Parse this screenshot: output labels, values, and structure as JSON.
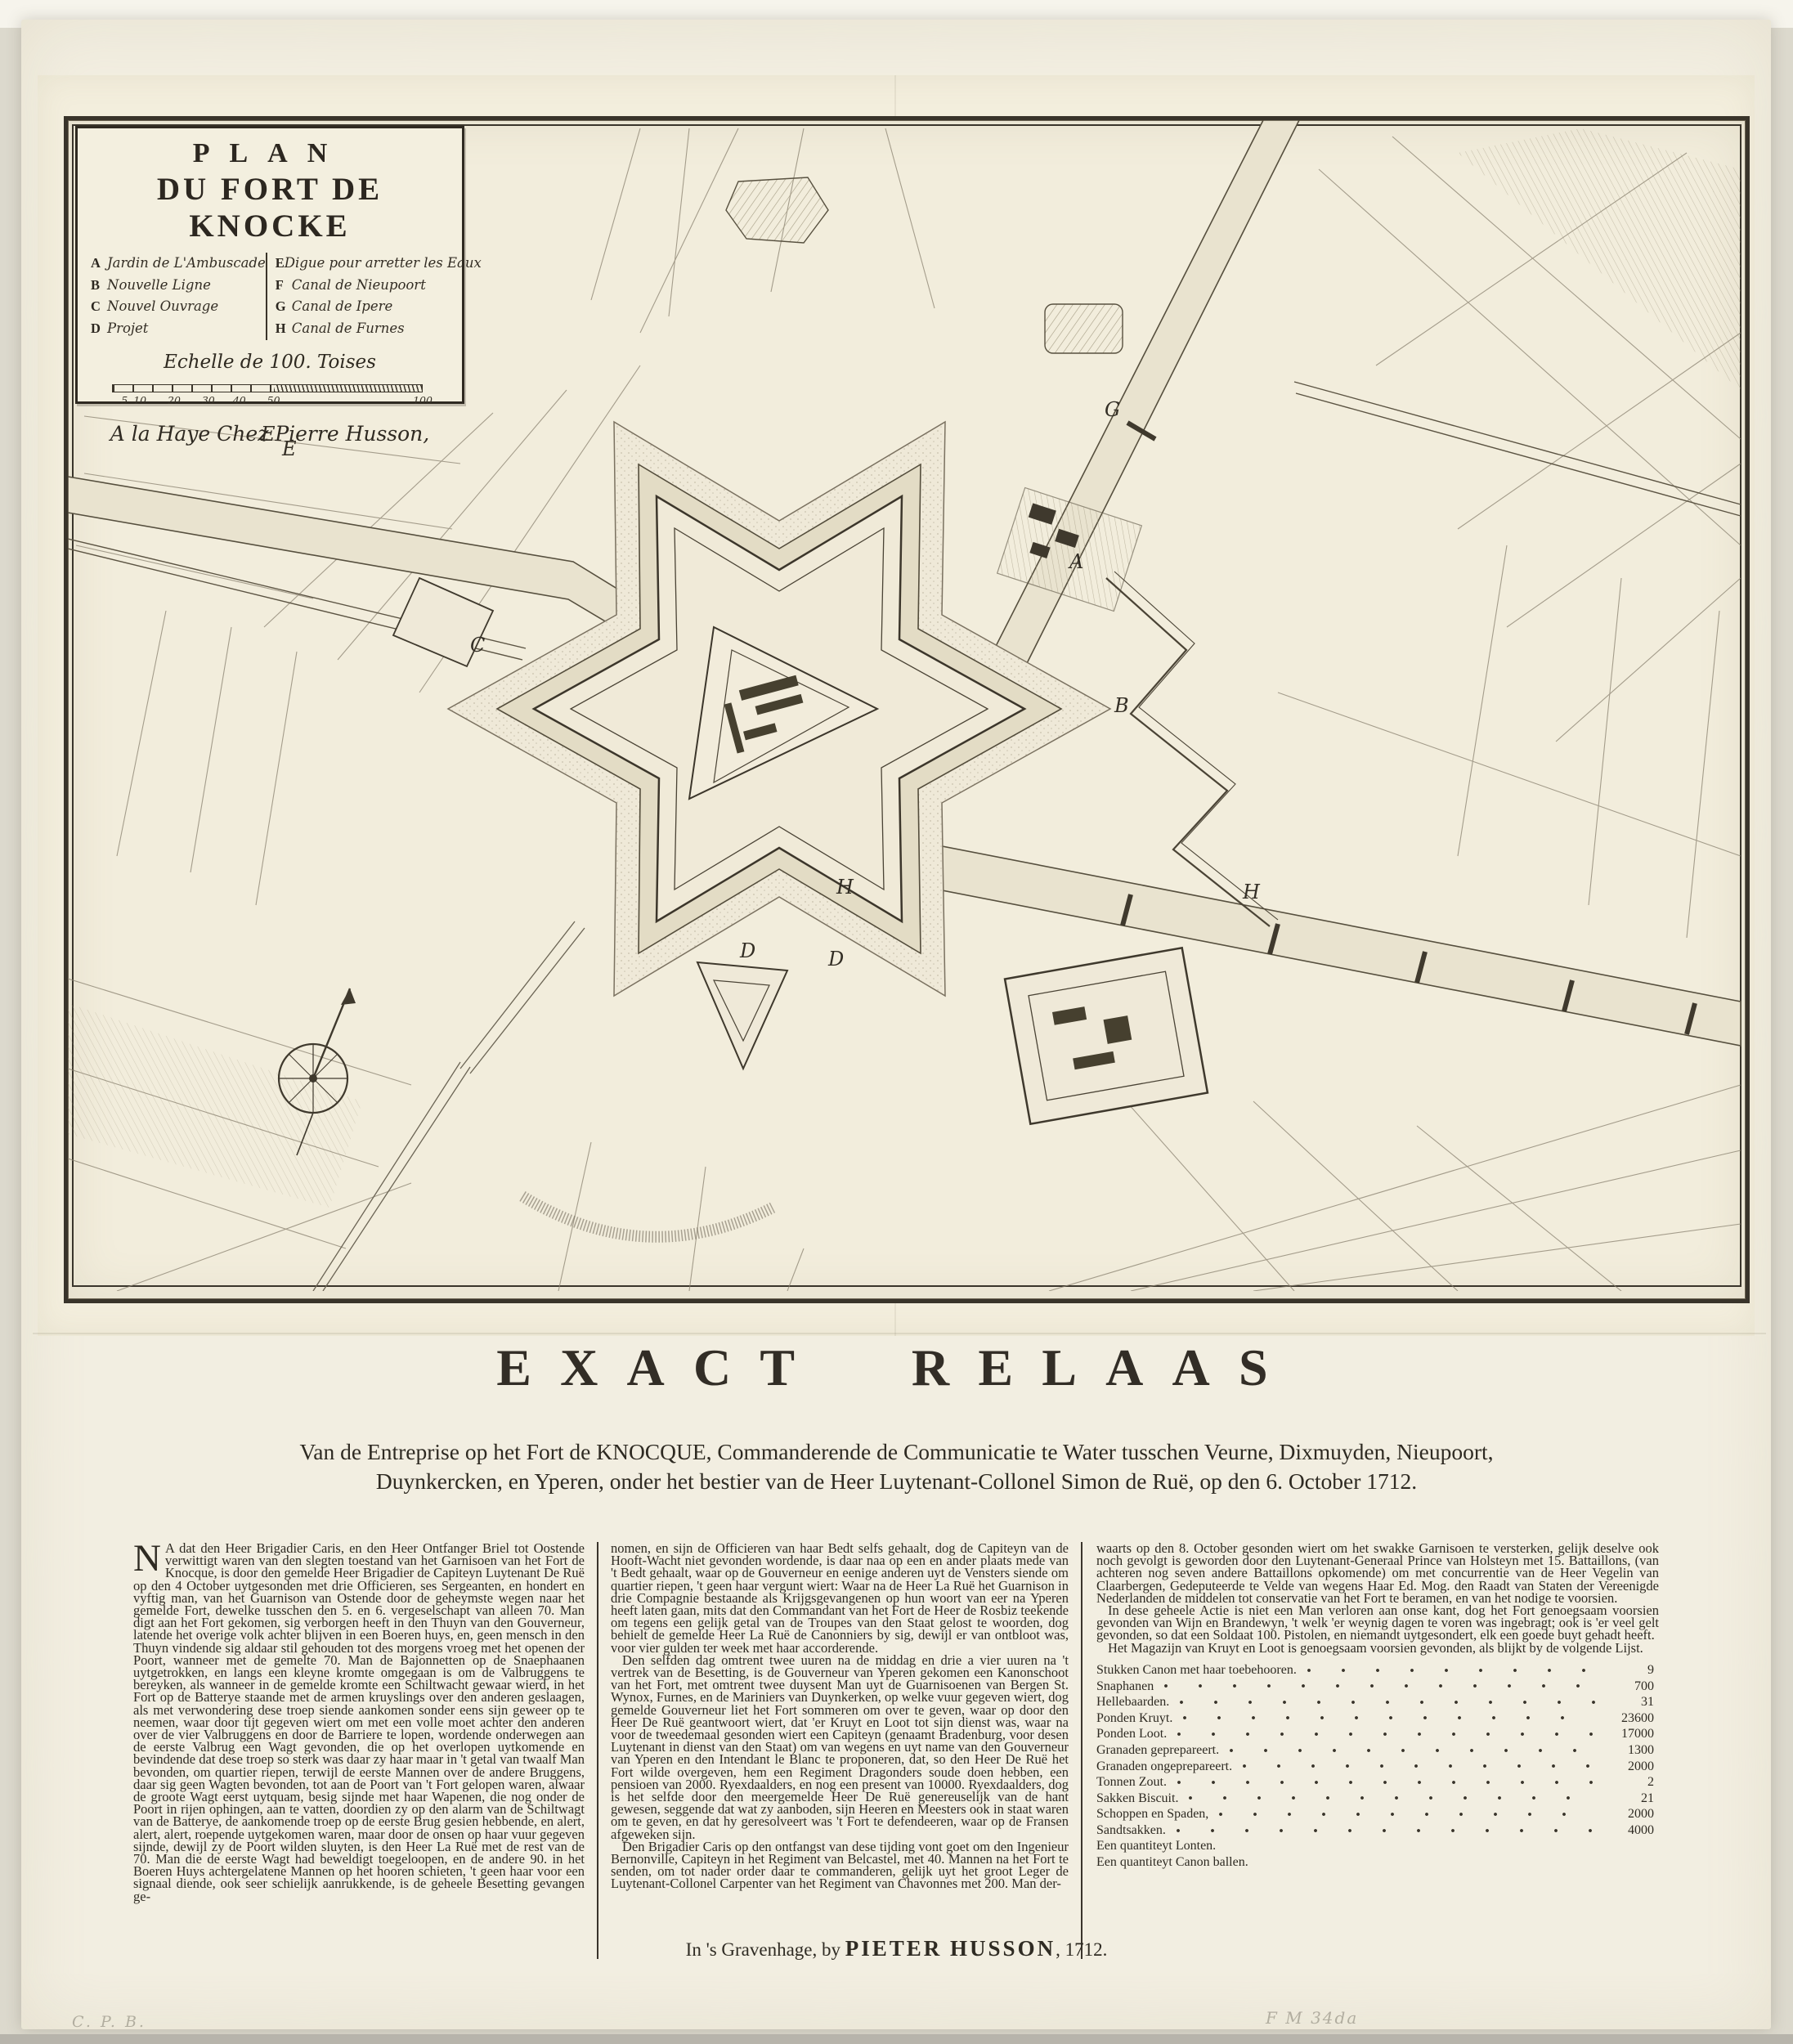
{
  "map": {
    "cartouche": {
      "title_line1": "PLAN",
      "title_line2": "DU FORT DE KNOCKE",
      "legend_left": [
        {
          "key": "A",
          "label": "Jardin de L'Ambuscade"
        },
        {
          "key": "B",
          "label": "Nouvelle Ligne"
        },
        {
          "key": "C",
          "label": "Nouvel Ouvrage"
        },
        {
          "key": "D",
          "label": "Projet"
        }
      ],
      "legend_right": [
        {
          "key": "E",
          "label": "Digue pour arretter les Eaux"
        },
        {
          "key": "F",
          "label": "Canal de Nieupoort"
        },
        {
          "key": "G",
          "label": "Canal de Ipere"
        },
        {
          "key": "H",
          "label": "Canal de Furnes"
        }
      ],
      "scale_label": "Echelle de 100. Toises",
      "scale_ticks": [
        "5",
        "10",
        "20",
        "30",
        "40",
        "50",
        "100"
      ],
      "imprint": "A la Haye Chez Pierre Husson,"
    },
    "letters": [
      "F",
      "E",
      "E",
      "G",
      "A",
      "B",
      "C",
      "D",
      "H",
      "D",
      "H"
    ]
  },
  "relaas": {
    "heading": "EXACT RELAAS",
    "subtitle_line1": "Van de Entreprise op het Fort de KNOCQUE, Commanderende de Communicatie te Water tusschen Veurne, Dixmuyden, Nieupoort,",
    "subtitle_line2": "Duynkercken, en Yperen, onder het bestier van de Heer Luytenant-Collonel Simon de Ruë, op den 6. October 1712.",
    "dropcap": "N",
    "col1_first": "A dat den Heer Brigadier Caris, en den Heer Ontfanger Briel tot Oostende verwittigt waren van den slegten toestand van het Garnisoen van het Fort de Knocque, is door den gemelde Heer Brigadier de Capiteyn Luytenant De Ruë op den 4 October uytgesonden met drie Officieren, ses Sergeanten, en hondert en vyftig man, van het Guarnison van Ostende door de geheymste wegen naar het gemelde Fort, dewelke tusschen den 5. en 6. vergeselschapt van alleen 70. Man digt aan het Fort gekomen, sig verborgen heeft in den Thuyn van den Gouverneur, latende het overige volk achter blijven in een Boeren huys, en, geen mensch in den Thuyn vindende sig aldaar stil gehouden tot des morgens vroeg met het openen der Poort, wanneer met de gemelte 70. Man de Bajonnetten op de Snaephaanen uytgetrokken, en langs een kleyne kromte omgegaan is om de Valbruggens te bereyken, als wanneer in de gemelde kromte een Schiltwacht gewaar wierd, in het Fort op de Batterye staande met de armen kruyslings over den anderen geslaagen, als met verwondering dese troep siende aankomen sonder eens sijn geweer op te neemen, waar door tijt gegeven wiert om met een volle moet achter den anderen over de vier Valbruggens en door de Barriere te lopen, wordende onderwegen aan de eerste Valbrug een Wagt gevonden, die op het overlopen uytkomende en bevindende dat dese troep so sterk was daar zy haar maar in 't getal van twaalf Man bevonden, om quartier riepen, terwijl de eerste Mannen over de andere Bruggens, daar sig geen Wagten bevonden, tot aan de Poort van 't Fort gelopen waren, alwaar de groote Wagt eerst uytquam, besig sijnde met haar Wapenen, die nog onder de Poort in rijen ophingen, aan te vatten, doordien zy op den alarm van de Schiltwagt van de Batterye, de aankomende troep op de eerste Brug gesien hebbende, en alert, alert, alert, roepende uytgekomen waren, maar door de onsen op haar vuur gegeven sijnde, dewijl zy de Poort wilden sluyten, is den Heer La Ruë met de rest van de 70. Man die de eerste Wagt had beweldigt toegeloopen, en de andere 90. in het Boeren Huys achtergelatene Mannen op het hooren schieten, 't geen haar voor een signaal diende, ook seer schielijk aanrukkende, is de geheele Besetting gevangen ge-",
    "col2": [
      "nomen, en sijn de Officieren van haar Bedt selfs gehaalt, dog de Capiteyn van de Hooft-Wacht niet gevonden wordende, is daar naa op een en ander plaats mede van 't Bedt gehaalt, waar op de Gouverneur en eenige anderen uyt de Vensters siende om quartier riepen, 't geen haar vergunt wiert: Waar na de Heer La Ruë het Guarnison in drie Compagnie bestaande als Krijgsgevangenen op hun woort van eer na Yperen heeft laten gaan, mits dat den Commandant van het Fort de Heer de Rosbiz teekende om tegens een gelijk getal van de Troupes van den Staat gelost te woorden, dog behielt de gemelde Heer La Ruë de Canonniers by sig, dewijl er van ontbloot was, voor vier gulden ter week met haar accorderende.",
      "Den selfden dag omtrent twee uuren na de middag en drie a vier uuren na 't vertrek van de Besetting, is de Gouverneur van Yperen gekomen een Kanonschoot van het Fort, met omtrent twee duysent Man uyt de Guarnisoenen van Bergen St. Wynox, Furnes, en de Mariniers van Duynkerken, op welke vuur gegeven wiert, dog gemelde Gouverneur liet het Fort sommeren om over te geven, waar op door den Heer De Ruë geantwoort wiert, dat 'er Kruyt en Loot tot sijn dienst was, waar na voor de tweedemaal gesonden wiert een Capiteyn (genaamt Bradenburg, voor desen Luytenant in dienst van den Staat) om van wegens en uyt name van den Gouverneur van Yperen en den Intendant le Blanc te proponeren, dat, so den Heer De Ruë het Fort wilde overgeven, hem een Regiment Dragonders soude doen hebben, een pensioen van 2000. Ryexdaalders, en nog een present van 10000. Ryexdaalders, dog is het selfde door den meergemelde Heer De Ruë genereuselijk van de hant gewesen, seggende dat wat zy aanboden, sijn Heeren en Meesters ook in staat waren om te geven, en dat hy geresolveert was 't Fort te defendeeren, waar op de Fransen afgeweken sijn.",
      "Den Brigadier Caris op den ontfangst van dese tijding vont goet om den Ingenieur Bernonville, Capiteyn in het Regiment van Belcastel, met 40. Mannen na het Fort te senden, om tot nader order daar te commanderen, gelijk uyt het groot Leger de Luytenant-Collonel Carpenter van het Regiment van Chavonnes met 200. Man der-"
    ],
    "col3": [
      "waarts op den 8. October gesonden wiert om het swakke Garnisoen te versterken, gelijk deselve ook noch gevolgt is geworden door den Luytenant-Generaal Prince van Holsteyn met 15. Battaillons, (van achteren nog seven andere Battaillons opkomende) om met concurrentie van de Heer Vegelin van Claarbergen, Gedeputeerde te Velde van wegens Haar Ed. Mog. den Raadt van Staten der Vereenigde Nederlanden de middelen tot conservatie van het Fort te beramen, en van het nodige te voorsien.",
      "In dese geheele Actie is niet een Man verloren aan onse kant, dog het Fort genoegsaam voorsien gevonden van Wijn en Brandewyn, 't welk 'er weynig dagen te voren was ingebragt; ook is 'er veel gelt gevonden, so dat een Soldaat 100. Pistolen, en niemandt uytgesondert, elk een goede buyt gehadt heeft.",
      "Het Magazijn van Kruyt en Loot is genoegsaam voorsien gevonden, als blijkt by de volgende Lijst."
    ],
    "inventory": {
      "rows": [
        {
          "label": "Stukken Canon met haar toebehooren.",
          "value": "9"
        },
        {
          "label": "Snaphanen",
          "value": "700"
        },
        {
          "label": "Hellebaarden.",
          "value": "31"
        },
        {
          "label": "Ponden Kruyt.",
          "value": "23600"
        },
        {
          "label": "Ponden Loot.",
          "value": "17000"
        },
        {
          "label": "Granaden geprepareert.",
          "value": "1300"
        },
        {
          "label": "Granaden ongeprepareert.",
          "value": "2000"
        },
        {
          "label": "Tonnen Zout.",
          "value": "2"
        },
        {
          "label": "Sakken Biscuit.",
          "value": "21"
        },
        {
          "label": "Schoppen en Spaden,",
          "value": "2000"
        },
        {
          "label": "Sandtsakken.",
          "value": "4000"
        }
      ],
      "extra": [
        "Een quantiteyt Lonten.",
        "Een quantiteyt Canon ballen."
      ]
    },
    "imprint_pre": "In 's Gravenhage, by ",
    "imprint_name": "PIETER HUSSON",
    "imprint_post": ", 1712."
  },
  "annotations": {
    "bottom_left": "C. P. B.",
    "bottom_right": "F M 34da"
  },
  "colors": {
    "paper": "#f2eee1",
    "plate_paper": "#f3eedd",
    "ink": "#2e2a22",
    "engraving": "#3a342a"
  }
}
